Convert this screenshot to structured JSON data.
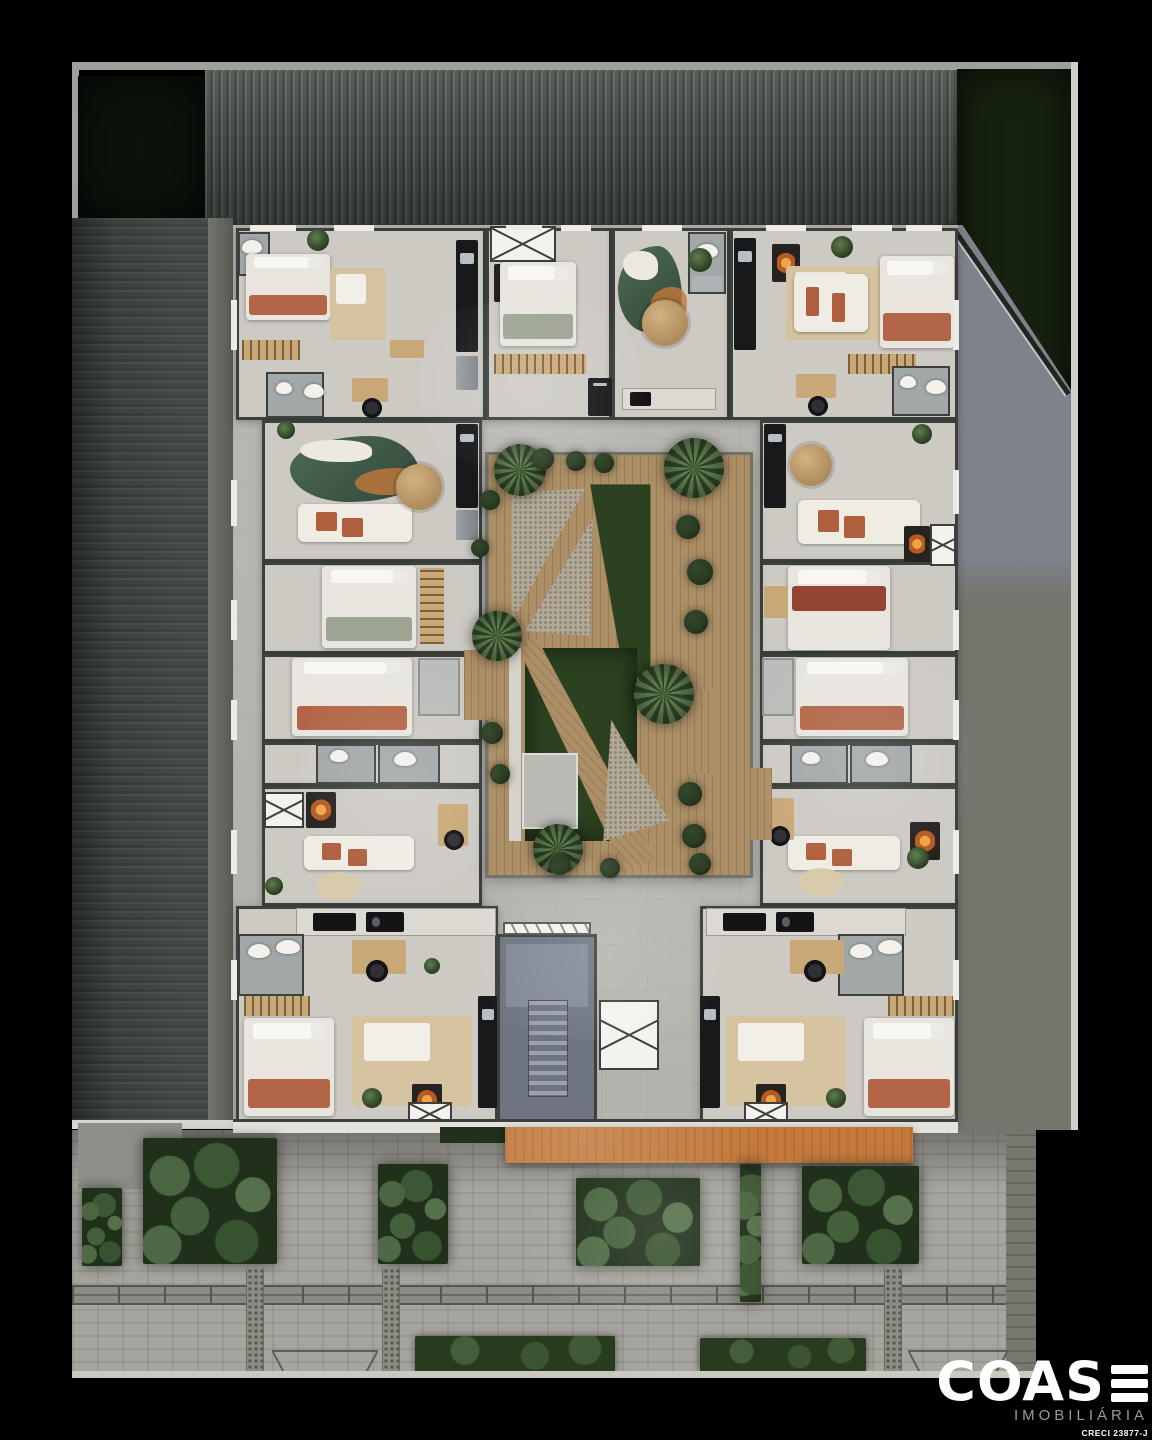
{
  "logo": {
    "brand": "COAS",
    "tagline": "IMOBILIÁRIA",
    "creci": "CRECI 23877-J"
  },
  "palette": {
    "bg": "#000000",
    "plate": "#b4b2ac",
    "room": "#cdcac4",
    "wall": "#3b403c",
    "grassDark": "#0c130c",
    "grassSide": "#16210f",
    "yardTop": "#7e828b",
    "yardBottom": "#73766d",
    "wood": "#ac8f66",
    "lawn": "#2c4120",
    "gravel": "#b1a995",
    "orange": "#c3793c",
    "paver": "#a5a49d",
    "paverDark": "#79786f",
    "terracotta": "#af5f3e",
    "sage": "#9aa08f",
    "darkred": "#8e3b28",
    "beige": "#d5c3a0",
    "bathfloor": "#a2a7a8",
    "stair": "#6e7581",
    "stairLight": "#828a96",
    "logoGray": "#9a9a9a"
  },
  "scene": {
    "rooms": [
      [
        236,
        228,
        250,
        192
      ],
      [
        486,
        228,
        126,
        192
      ],
      [
        612,
        228,
        118,
        192
      ],
      [
        730,
        228,
        228,
        192
      ],
      [
        262,
        420,
        220,
        142
      ],
      [
        262,
        562,
        220,
        92
      ],
      [
        262,
        654,
        220,
        88
      ],
      [
        262,
        742,
        220,
        44
      ],
      [
        262,
        786,
        220,
        120
      ],
      [
        760,
        420,
        198,
        142
      ],
      [
        760,
        562,
        198,
        92
      ],
      [
        760,
        654,
        198,
        88
      ],
      [
        760,
        742,
        198,
        44
      ],
      [
        760,
        786,
        198,
        120
      ],
      [
        236,
        906,
        262,
        218
      ],
      [
        700,
        906,
        258,
        218
      ]
    ],
    "furniture": [
      [
        "bath",
        238,
        232,
        32,
        44
      ],
      [
        "wc",
        242,
        240,
        20,
        14
      ],
      [
        "bed",
        246,
        254,
        84,
        66
      ],
      [
        "rack",
        242,
        340,
        58,
        20
      ],
      [
        "daybed",
        330,
        268,
        56,
        72
      ],
      [
        "desk",
        390,
        340,
        34,
        18
      ],
      [
        "cnt",
        456,
        240,
        22,
        112
      ],
      [
        "fridge",
        456,
        356,
        22,
        34
      ],
      [
        "desk",
        352,
        378,
        36,
        24
      ],
      [
        "chair",
        362,
        398,
        20,
        20
      ],
      [
        "bath",
        266,
        372,
        58,
        46
      ],
      [
        "wc",
        276,
        382,
        16,
        12
      ],
      [
        "wc",
        304,
        384,
        20,
        14
      ],
      [
        "elev",
        490,
        226,
        66,
        36
      ],
      [
        "fire",
        494,
        264,
        34,
        38
      ],
      [
        "bed2",
        500,
        262,
        76,
        84
      ],
      [
        "rack",
        494,
        354,
        92,
        20
      ],
      [
        "cnt",
        588,
        378,
        24,
        38
      ],
      [
        "blob",
        618,
        246,
        64,
        86
      ],
      [
        "tbl",
        642,
        300,
        46,
        46
      ],
      [
        "kitch",
        622,
        388,
        94,
        22
      ],
      [
        "bath",
        688,
        232,
        38,
        62
      ],
      [
        "wc",
        696,
        244,
        22,
        14
      ],
      [
        "steel",
        692,
        276,
        30,
        16
      ],
      [
        "cnt",
        734,
        238,
        22,
        112
      ],
      [
        "fire",
        772,
        244,
        28,
        38
      ],
      [
        "daybed",
        786,
        266,
        94,
        74
      ],
      [
        "sofa",
        794,
        274,
        74,
        58
      ],
      [
        "bed",
        880,
        256,
        74,
        92
      ],
      [
        "rack",
        848,
        354,
        68,
        20
      ],
      [
        "desk",
        796,
        374,
        40,
        24
      ],
      [
        "chair",
        808,
        396,
        20,
        20
      ],
      [
        "bath",
        892,
        366,
        58,
        50
      ],
      [
        "wc",
        900,
        376,
        16,
        12
      ],
      [
        "wc",
        926,
        380,
        20,
        14
      ],
      [
        "cnt",
        456,
        424,
        22,
        84
      ],
      [
        "fridge",
        456,
        510,
        22,
        30
      ],
      [
        "blob",
        290,
        436,
        130,
        66
      ],
      [
        "sofa",
        298,
        504,
        114,
        38
      ],
      [
        "tbl",
        396,
        464,
        46,
        46
      ],
      [
        "bed2",
        322,
        566,
        94,
        82
      ],
      [
        "rackv",
        420,
        568,
        24,
        76
      ],
      [
        "bed",
        292,
        658,
        120,
        78
      ],
      [
        "ward",
        418,
        658,
        42,
        58
      ],
      [
        "bath",
        316,
        744,
        60,
        40
      ],
      [
        "wc",
        330,
        750,
        18,
        12
      ],
      [
        "bath",
        378,
        744,
        62,
        40
      ],
      [
        "wc",
        394,
        752,
        22,
        14
      ],
      [
        "elev",
        264,
        792,
        40,
        36
      ],
      [
        "fire",
        306,
        792,
        30,
        36
      ],
      [
        "sofa",
        304,
        836,
        110,
        34
      ],
      [
        "rug",
        316,
        872,
        46,
        28
      ],
      [
        "desk",
        438,
        804,
        30,
        42
      ],
      [
        "chair",
        444,
        830,
        20,
        20
      ],
      [
        "cnt",
        764,
        424,
        22,
        84
      ],
      [
        "tbl",
        790,
        444,
        42,
        42
      ],
      [
        "sofa",
        798,
        500,
        122,
        44
      ],
      [
        "fire",
        904,
        526,
        26,
        36
      ],
      [
        "elev",
        930,
        524,
        26,
        42
      ],
      [
        "bedr",
        788,
        566,
        102,
        84
      ],
      [
        "desk",
        764,
        586,
        24,
        32
      ],
      [
        "bed",
        796,
        658,
        112,
        78
      ],
      [
        "ward",
        762,
        658,
        32,
        58
      ],
      [
        "bath",
        790,
        744,
        58,
        40
      ],
      [
        "wc",
        802,
        752,
        18,
        12
      ],
      [
        "bath",
        850,
        744,
        62,
        40
      ],
      [
        "wc",
        866,
        752,
        22,
        14
      ],
      [
        "sofa",
        788,
        836,
        112,
        34
      ],
      [
        "rug",
        798,
        868,
        46,
        28
      ],
      [
        "desk",
        764,
        798,
        30,
        42
      ],
      [
        "chair",
        770,
        826,
        20,
        20
      ],
      [
        "fire",
        910,
        822,
        30,
        38
      ],
      [
        "kitch",
        296,
        908,
        200,
        28
      ],
      [
        "stove",
        366,
        912,
        38,
        20
      ],
      [
        "bath",
        238,
        934,
        66,
        62
      ],
      [
        "wc",
        248,
        944,
        22,
        14
      ],
      [
        "wc",
        276,
        940,
        24,
        14
      ],
      [
        "desk",
        352,
        940,
        54,
        34
      ],
      [
        "chair",
        366,
        960,
        22,
        22
      ],
      [
        "rack",
        244,
        996,
        66,
        20
      ],
      [
        "bed",
        244,
        1018,
        90,
        98
      ],
      [
        "daybed",
        352,
        1016,
        120,
        90
      ],
      [
        "cnt",
        478,
        996,
        20,
        112
      ],
      [
        "fire",
        412,
        1084,
        30,
        32
      ],
      [
        "elev",
        408,
        1102,
        44,
        22
      ],
      [
        "kitch",
        706,
        908,
        200,
        28
      ],
      [
        "stove",
        776,
        912,
        38,
        20
      ],
      [
        "bath",
        838,
        934,
        66,
        62
      ],
      [
        "wc",
        850,
        944,
        22,
        14
      ],
      [
        "wc",
        878,
        940,
        24,
        14
      ],
      [
        "desk",
        790,
        940,
        54,
        34
      ],
      [
        "chair",
        804,
        960,
        22,
        22
      ],
      [
        "rack",
        888,
        996,
        66,
        20
      ],
      [
        "bed",
        864,
        1018,
        90,
        98
      ],
      [
        "daybed",
        726,
        1016,
        120,
        90
      ],
      [
        "cnt",
        700,
        996,
        20,
        112
      ],
      [
        "fire",
        756,
        1084,
        30,
        32
      ],
      [
        "elev",
        744,
        1102,
        44,
        22
      ],
      [
        "wd",
        464,
        650,
        24,
        70
      ],
      [
        "wd",
        750,
        768,
        22,
        72
      ]
    ],
    "sills": [
      [
        250,
        225,
        46,
        6
      ],
      [
        334,
        225,
        40,
        6
      ],
      [
        506,
        225,
        36,
        6
      ],
      [
        561,
        225,
        30,
        6
      ],
      [
        642,
        225,
        40,
        6
      ],
      [
        766,
        225,
        40,
        6
      ],
      [
        852,
        225,
        40,
        6
      ],
      [
        906,
        225,
        36,
        6
      ],
      [
        250,
        1119,
        60,
        7
      ],
      [
        350,
        1119,
        50,
        7
      ],
      [
        530,
        1119,
        44,
        7
      ],
      [
        700,
        1119,
        50,
        7
      ],
      [
        820,
        1119,
        50,
        7
      ],
      [
        900,
        1119,
        40,
        7
      ],
      [
        231,
        300,
        6,
        50
      ],
      [
        231,
        480,
        6,
        46
      ],
      [
        231,
        600,
        6,
        40
      ],
      [
        231,
        700,
        6,
        40
      ],
      [
        231,
        830,
        6,
        44
      ],
      [
        231,
        960,
        6,
        40
      ],
      [
        953,
        300,
        6,
        50
      ],
      [
        953,
        470,
        6,
        44
      ],
      [
        953,
        610,
        6,
        40
      ],
      [
        953,
        700,
        6,
        40
      ],
      [
        953,
        830,
        6,
        44
      ],
      [
        953,
        960,
        6,
        40
      ]
    ],
    "palms": [
      [
        520,
        470,
        26
      ],
      [
        694,
        468,
        30
      ],
      [
        497,
        636,
        25
      ],
      [
        664,
        694,
        30
      ],
      [
        558,
        849,
        25
      ]
    ],
    "bushes": [
      [
        543,
        459,
        11
      ],
      [
        576,
        461,
        10
      ],
      [
        604,
        463,
        10
      ],
      [
        688,
        527,
        12
      ],
      [
        700,
        572,
        13
      ],
      [
        696,
        622,
        12
      ],
      [
        690,
        794,
        12
      ],
      [
        694,
        836,
        12
      ],
      [
        700,
        864,
        11
      ],
      [
        560,
        864,
        11
      ],
      [
        610,
        868,
        10
      ],
      [
        492,
        733,
        11
      ],
      [
        500,
        774,
        10
      ],
      [
        490,
        500,
        10
      ],
      [
        480,
        548,
        9
      ]
    ],
    "pots": [
      [
        318,
        240,
        11
      ],
      [
        700,
        260,
        12
      ],
      [
        842,
        247,
        11
      ],
      [
        372,
        1098,
        10
      ],
      [
        836,
        1098,
        10
      ],
      [
        918,
        858,
        11
      ],
      [
        286,
        430,
        9
      ],
      [
        922,
        434,
        10
      ],
      [
        274,
        886,
        9
      ],
      [
        432,
        966,
        8
      ]
    ],
    "street": {
      "beds": [
        [
          143,
          1138,
          134,
          126
        ],
        [
          378,
          1164,
          70,
          100
        ],
        [
          576,
          1178,
          124,
          88
        ],
        [
          740,
          1164,
          21,
          138
        ],
        [
          802,
          1166,
          117,
          98
        ],
        [
          82,
          1188,
          40,
          78
        ]
      ],
      "hedges": [
        [
          415,
          1336,
          200,
          36
        ],
        [
          700,
          1338,
          166,
          34
        ]
      ],
      "tactile": [
        [
          246,
          1268,
          16,
          108
        ],
        [
          382,
          1268,
          16,
          108
        ],
        [
          884,
          1268,
          16,
          108
        ]
      ],
      "driveways": [
        [
          272,
          1350,
          106,
          24
        ],
        [
          908,
          1350,
          100,
          24
        ]
      ]
    }
  }
}
